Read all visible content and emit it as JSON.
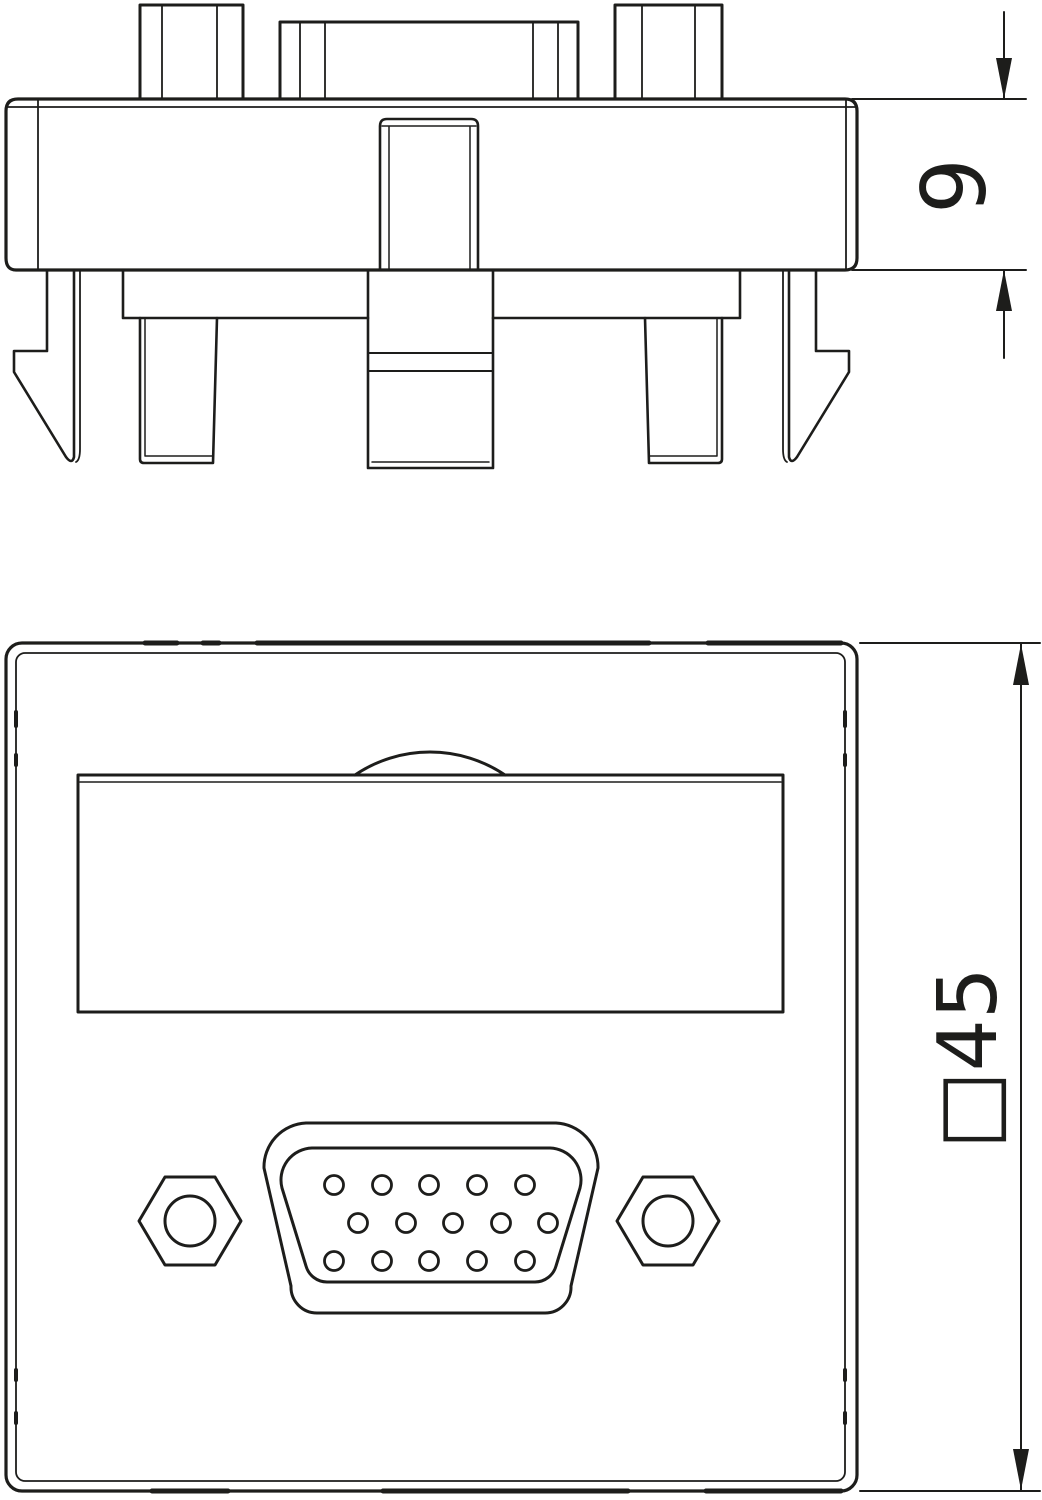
{
  "drawing": {
    "background": "#ffffff",
    "line_color": "#1d1d1b",
    "side_view": {
      "description": "module side profile with snap-in mounting clips",
      "thickness_dimension": "9"
    },
    "front_view": {
      "description": "45x45 module front plate with VGA socket",
      "size_dimension": "□45",
      "connector": "vga-d-sub-15-socket",
      "pin_rows": [
        5,
        5,
        5
      ],
      "pin_count": 15,
      "fixing_nuts": 2
    }
  }
}
